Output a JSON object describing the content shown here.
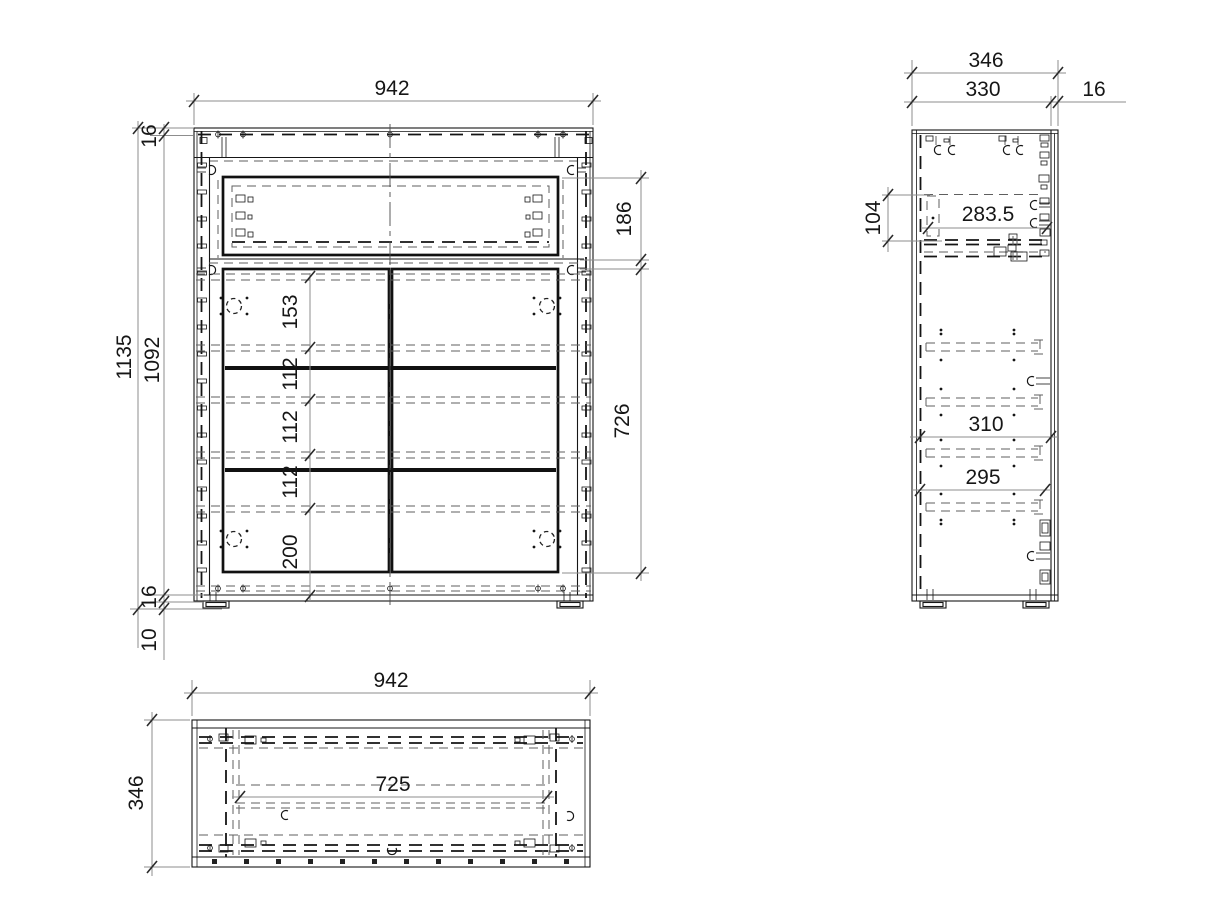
{
  "document": {
    "background": "#ffffff",
    "line_color": "#161616",
    "dim_line_color": "#8d8d8d",
    "text_color": "#161616"
  },
  "front_view": {
    "width": "942",
    "height_total": "1135",
    "height_inner": "1092",
    "top_panel_thickness": "16",
    "bottom_panel_thickness": "16",
    "plinth_height": "10",
    "drawer_front_height": "186",
    "door_height": "726",
    "shelf_segments": [
      "153",
      "112",
      "112",
      "112",
      "200"
    ]
  },
  "side_view": {
    "depth_total": "346",
    "depth_body": "330",
    "front_thickness": "16",
    "drawer_side_height": "104",
    "drawer_depth": "283.5",
    "shelf_depth_upper": "310",
    "shelf_depth_lower": "295"
  },
  "top_view": {
    "width": "942",
    "depth": "346",
    "inner_width": "725"
  }
}
